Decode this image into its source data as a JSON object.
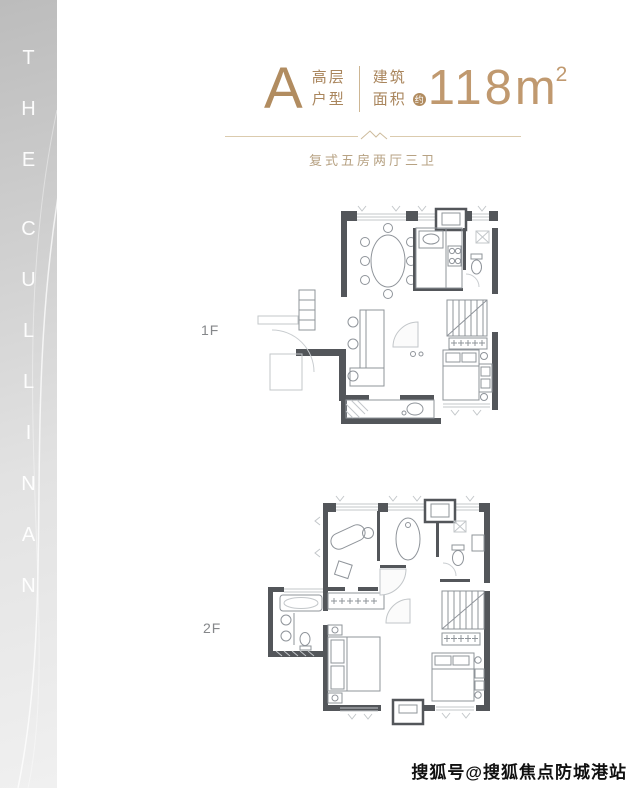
{
  "sidebar": {
    "brand": "THE CULLINAN",
    "letters": [
      "T",
      "H",
      "E",
      "C",
      "U",
      "L",
      "L",
      "I",
      "N",
      "A",
      "N"
    ]
  },
  "header": {
    "type_letter": "A",
    "type_line1": "高层",
    "type_line2": "户型",
    "area_line1": "建筑",
    "area_line2": "面积",
    "approx": "约",
    "area_value": "118",
    "area_unit": "m",
    "area_exp": "2",
    "subtitle": "复式五房两厅三卫",
    "accent_color": "#b18c60"
  },
  "floorplans": [
    {
      "label": "1F"
    },
    {
      "label": "2F"
    }
  ],
  "watermark": {
    "text": "搜狐号@搜狐焦点防城港站"
  }
}
